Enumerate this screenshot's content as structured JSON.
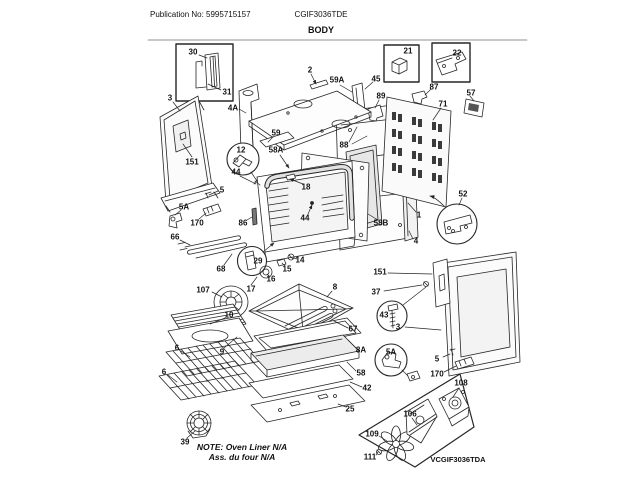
{
  "header": {
    "publication": "Publication No: 5995715157",
    "model": "CGIF3036TDE",
    "section": "BODY"
  },
  "note": {
    "line1": "NOTE: Oven Liner N/A",
    "line2": "Ass. du four N/A"
  },
  "module": {
    "label": "VCGIF3036TDA"
  },
  "callouts": [
    {
      "t": "30",
      "x": 193,
      "y": 52
    },
    {
      "t": "31",
      "x": 227,
      "y": 92
    },
    {
      "t": "3",
      "x": 170,
      "y": 98
    },
    {
      "t": "151",
      "x": 192,
      "y": 162
    },
    {
      "t": "4A",
      "x": 233,
      "y": 108
    },
    {
      "t": "2",
      "x": 310,
      "y": 70
    },
    {
      "t": "59A",
      "x": 337,
      "y": 80
    },
    {
      "t": "45",
      "x": 376,
      "y": 79
    },
    {
      "t": "21",
      "x": 408,
      "y": 51
    },
    {
      "t": "22",
      "x": 457,
      "y": 53
    },
    {
      "t": "87",
      "x": 434,
      "y": 87
    },
    {
      "t": "57",
      "x": 471,
      "y": 93
    },
    {
      "t": "89",
      "x": 381,
      "y": 96
    },
    {
      "t": "71",
      "x": 443,
      "y": 104
    },
    {
      "t": "59",
      "x": 276,
      "y": 133
    },
    {
      "t": "88",
      "x": 344,
      "y": 145
    },
    {
      "t": "58A",
      "x": 276,
      "y": 150
    },
    {
      "t": "12",
      "x": 241,
      "y": 150
    },
    {
      "t": "44",
      "x": 236,
      "y": 172
    },
    {
      "t": "18",
      "x": 306,
      "y": 187
    },
    {
      "t": "5",
      "x": 222,
      "y": 190
    },
    {
      "t": "52",
      "x": 463,
      "y": 194
    },
    {
      "t": "5A",
      "x": 184,
      "y": 207
    },
    {
      "t": "1",
      "x": 419,
      "y": 215
    },
    {
      "t": "44",
      "x": 305,
      "y": 218
    },
    {
      "t": "86",
      "x": 243,
      "y": 223
    },
    {
      "t": "170",
      "x": 197,
      "y": 223
    },
    {
      "t": "58B",
      "x": 381,
      "y": 223
    },
    {
      "t": "66",
      "x": 175,
      "y": 237
    },
    {
      "t": "4",
      "x": 416,
      "y": 241
    },
    {
      "t": "29",
      "x": 258,
      "y": 261
    },
    {
      "t": "14",
      "x": 300,
      "y": 260
    },
    {
      "t": "15",
      "x": 287,
      "y": 269
    },
    {
      "t": "68",
      "x": 221,
      "y": 269
    },
    {
      "t": "151",
      "x": 380,
      "y": 272
    },
    {
      "t": "16",
      "x": 271,
      "y": 279
    },
    {
      "t": "17",
      "x": 251,
      "y": 289
    },
    {
      "t": "107",
      "x": 203,
      "y": 290
    },
    {
      "t": "37",
      "x": 376,
      "y": 292
    },
    {
      "t": "8",
      "x": 335,
      "y": 287
    },
    {
      "t": "43",
      "x": 384,
      "y": 315
    },
    {
      "t": "10",
      "x": 229,
      "y": 315
    },
    {
      "t": "3",
      "x": 398,
      "y": 327
    },
    {
      "t": "67",
      "x": 353,
      "y": 329
    },
    {
      "t": "6",
      "x": 177,
      "y": 348
    },
    {
      "t": "8A",
      "x": 361,
      "y": 350
    },
    {
      "t": "9",
      "x": 222,
      "y": 352
    },
    {
      "t": "5A",
      "x": 391,
      "y": 352
    },
    {
      "t": "5",
      "x": 437,
      "y": 359
    },
    {
      "t": "6",
      "x": 164,
      "y": 372
    },
    {
      "t": "58",
      "x": 361,
      "y": 373
    },
    {
      "t": "170",
      "x": 437,
      "y": 374
    },
    {
      "t": "108",
      "x": 461,
      "y": 383
    },
    {
      "t": "42",
      "x": 367,
      "y": 388
    },
    {
      "t": "25",
      "x": 350,
      "y": 409
    },
    {
      "t": "106",
      "x": 410,
      "y": 414
    },
    {
      "t": "109",
      "x": 372,
      "y": 434
    },
    {
      "t": "39",
      "x": 185,
      "y": 442
    },
    {
      "t": "111",
      "x": 370,
      "y": 457
    }
  ]
}
